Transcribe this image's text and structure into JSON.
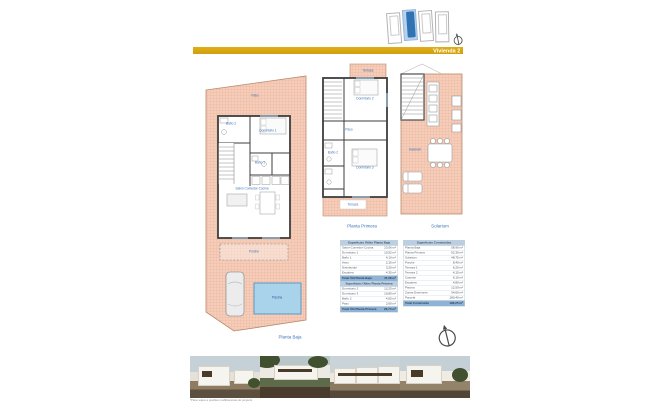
{
  "banner": {
    "label": "Vivienda 2"
  },
  "colors": {
    "banner_gold": "#CF9F0E",
    "label_blue": "#3C74B8",
    "terrace_pink": "#F5CDB9",
    "pool_blue": "#A9D3EA",
    "unit_highlight_blue": "#2E74B5"
  },
  "site_plan": {
    "units": 4,
    "highlighted_unit": 2
  },
  "plans": [
    {
      "caption": "Planta Baja",
      "labels": {
        "patio": "Patio",
        "bano2": "Baño 2",
        "dormitorio1": "Dormitorio 1",
        "bano1": "Baño 1",
        "salon": "Salón Comedor Cocina",
        "porche": "Porche",
        "piscina": "Piscina"
      }
    },
    {
      "caption": "Planta Primera",
      "labels": {
        "terraza_sup": "Terraza",
        "dormitorio2": "Dormitorio 2",
        "paso": "Paso",
        "bano2": "Baño 2",
        "dormitorio3": "Dormitorio 3",
        "terraza_inf": "Terraza"
      }
    },
    {
      "caption": "Solarium",
      "labels": {
        "solarium": "Solarium"
      }
    }
  ],
  "tables": [
    {
      "title": "Superficies Útiles Planta Baja",
      "rows": [
        [
          "Salón-Comedor-Cocina",
          "23,06 m²"
        ],
        [
          "Dormitorio 1",
          "10,52 m²"
        ],
        [
          "Baño 1",
          "4,10 m²"
        ],
        [
          "Aseo",
          "2,15 m²"
        ],
        [
          "Distribuidor",
          "3,20 m²"
        ],
        [
          "Escalera",
          "4,35 m²"
        ]
      ],
      "total": [
        "Total Útil Planta Baja",
        "47,38 m²"
      ]
    },
    {
      "title": "Superficies Útiles Planta Primera",
      "rows": [
        [
          "Dormitorio 2",
          "12,25 m²"
        ],
        [
          "Dormitorio 3",
          "10,80 m²"
        ],
        [
          "Baño 2",
          "4,05 m²"
        ],
        [
          "Paso",
          "2,60 m²"
        ]
      ],
      "total": [
        "Total Útil Planta Primera",
        "29,70 m²"
      ]
    },
    {
      "title": "Superficies Construidas",
      "rows": [
        [
          "Planta Baja",
          "58,90 m²"
        ],
        [
          "Planta Primera",
          "52,30 m²"
        ],
        [
          "Solarium",
          "48,75 m²"
        ],
        [
          "Porche",
          "8,40 m²"
        ],
        [
          "Terraza 1",
          "6,20 m²"
        ],
        [
          "Terraza 2",
          "4,15 m²"
        ],
        [
          "Casetón",
          "6,10 m²"
        ],
        [
          "Escalera",
          "4,80 m²"
        ],
        [
          "Piscina",
          "12,50 m²"
        ],
        [
          "Zonas Exteriores",
          "34,60 m²"
        ],
        [
          "Parcela",
          "180,40 m²"
        ]
      ],
      "total": [
        "Total Construida",
        "196,25 m²"
      ]
    }
  ],
  "footer": {
    "disclaimer": "*Plano sujeto a posibles modificaciones de proyecto"
  }
}
